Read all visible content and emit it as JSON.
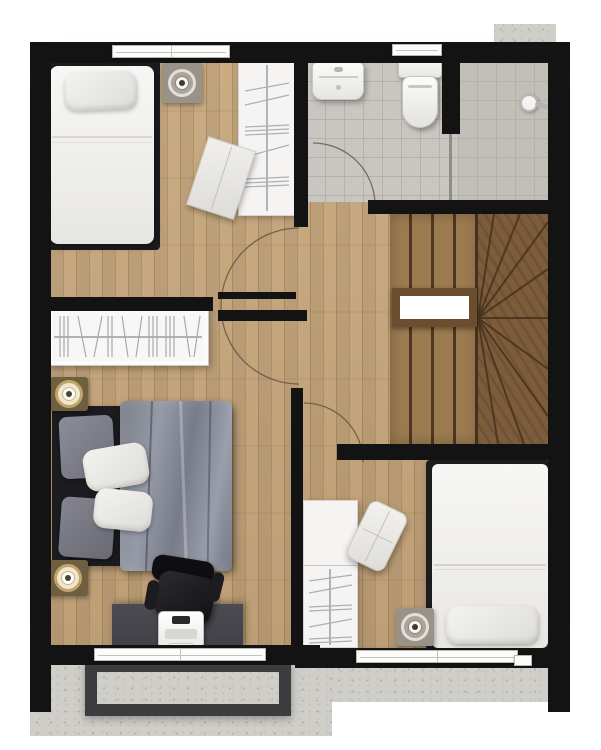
{
  "meta": {
    "type": "floor-plan",
    "view": "top-down",
    "has_visible_text": false
  },
  "colors": {
    "wall": "#131313",
    "wood": "#c7a77c",
    "tile": "#c9c6c1",
    "tile-line": "#b5b1ab",
    "shower-tile": "#c2beb8",
    "stair-light": "#9d7b50",
    "stair-seam": "#4d3822",
    "stair-dark": "#7d5c3c",
    "stair-line": "#46321e",
    "stair-frame": "#6b4e2f",
    "concrete": "#d0cec9",
    "planter-frame": "#3c3c3e",
    "bed-frame-dark": "#1c1c20",
    "duvet": "#878b97",
    "desk": "#46474c",
    "chair": "#1a1a1d",
    "speaker-gold": "#c2a368",
    "speaker-body": "#6d5f40",
    "speaker-gray": "#999286",
    "arc": "#5d4c38"
  },
  "rooms": [
    {
      "name": "bedroom-top-left",
      "furniture": [
        "single-bed",
        "pillow",
        "ceiling-speaker",
        "wardrobe-with-hangers",
        "floor-mat",
        "window"
      ]
    },
    {
      "name": "bathroom",
      "furniture": [
        "wash-basin",
        "toilet",
        "window",
        "door-swing"
      ]
    },
    {
      "name": "shower-room",
      "furniture": [
        "shower-head",
        "glass-partition",
        "tiled-floor"
      ]
    },
    {
      "name": "staircase",
      "furniture": [
        "straight-treads",
        "winder-treads",
        "stair-void-opening"
      ]
    },
    {
      "name": "hallway",
      "furniture": [
        "door-swing-180",
        "door-swing"
      ]
    },
    {
      "name": "bedroom-bottom-left",
      "furniture": [
        "bookshelf",
        "double-bed",
        "gray-pillows",
        "white-pillows",
        "duvet",
        "ceiling-speaker",
        "ceiling-speaker",
        "office-chair",
        "desk",
        "laptop",
        "window"
      ]
    },
    {
      "name": "balcony",
      "furniture": [
        "concrete-deck",
        "planter-frame"
      ]
    },
    {
      "name": "bedroom-bottom-right",
      "furniture": [
        "wardrobe-with-hangers",
        "lounge-chair",
        "ceiling-speaker",
        "single-bed",
        "pillow",
        "window",
        "concrete-ledge"
      ]
    }
  ]
}
